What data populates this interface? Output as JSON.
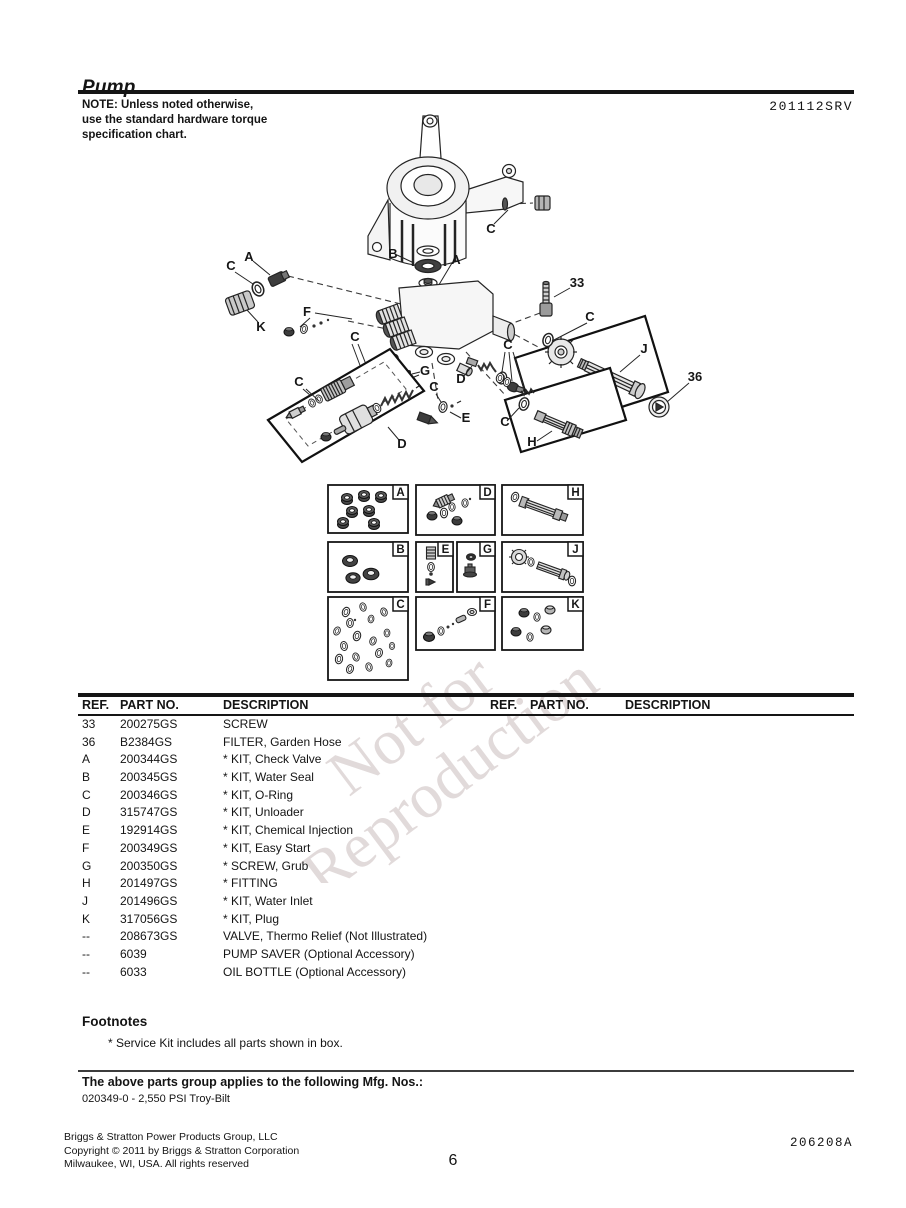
{
  "page": {
    "title": "Pump",
    "doc_number": "201112SRV",
    "note_lines": [
      "NOTE: Unless noted otherwise,",
      "use the standard hardware torque",
      "specification chart."
    ],
    "watermark": [
      "Not for",
      "Reproduction"
    ],
    "page_number": "6",
    "footer_code": "206208A",
    "footer_lines": [
      "Briggs & Stratton Power Products Group, LLC",
      "Copyright © 2011 by Briggs & Stratton Corporation",
      "Milwaukee, WI, USA. All rights reserved"
    ]
  },
  "diagram": {
    "callouts": [
      {
        "label": "C",
        "x": 491,
        "y": 233
      },
      {
        "label": "B",
        "x": 393,
        "y": 258
      },
      {
        "label": "A",
        "x": 456,
        "y": 264
      },
      {
        "label": "A",
        "x": 249,
        "y": 261
      },
      {
        "label": "C",
        "x": 231,
        "y": 270
      },
      {
        "label": "K",
        "x": 261,
        "y": 331
      },
      {
        "label": "F",
        "x": 307,
        "y": 316
      },
      {
        "label": "33",
        "x": 577,
        "y": 287
      },
      {
        "label": "C",
        "x": 590,
        "y": 321
      },
      {
        "label": "J",
        "x": 644,
        "y": 353
      },
      {
        "label": "36",
        "x": 695,
        "y": 381
      },
      {
        "label": "C",
        "x": 355,
        "y": 341
      },
      {
        "label": "C",
        "x": 299,
        "y": 386
      },
      {
        "label": "G",
        "x": 425,
        "y": 375
      },
      {
        "label": "D",
        "x": 461,
        "y": 383
      },
      {
        "label": "C",
        "x": 434,
        "y": 391
      },
      {
        "label": "C",
        "x": 508,
        "y": 349
      },
      {
        "label": "E",
        "x": 466,
        "y": 422
      },
      {
        "label": "C",
        "x": 505,
        "y": 426
      },
      {
        "label": "H",
        "x": 532,
        "y": 446
      },
      {
        "label": "D",
        "x": 402,
        "y": 448
      }
    ],
    "kit_boxes": [
      {
        "label": "A",
        "x": 328,
        "y": 485,
        "w": 80,
        "h": 48
      },
      {
        "label": "D",
        "x": 416,
        "y": 485,
        "w": 79,
        "h": 50
      },
      {
        "label": "H",
        "x": 502,
        "y": 485,
        "w": 81,
        "h": 50
      },
      {
        "label": "B",
        "x": 328,
        "y": 542,
        "w": 80,
        "h": 50
      },
      {
        "label": "E",
        "x": 416,
        "y": 542,
        "w": 37,
        "h": 50
      },
      {
        "label": "G",
        "x": 457,
        "y": 542,
        "w": 38,
        "h": 50
      },
      {
        "label": "J",
        "x": 502,
        "y": 542,
        "w": 81,
        "h": 50
      },
      {
        "label": "C",
        "x": 328,
        "y": 597,
        "w": 80,
        "h": 83
      },
      {
        "label": "F",
        "x": 416,
        "y": 597,
        "w": 79,
        "h": 53
      },
      {
        "label": "K",
        "x": 502,
        "y": 597,
        "w": 81,
        "h": 53
      }
    ]
  },
  "parts_table": {
    "headers": [
      "REF.",
      "PART NO.",
      "DESCRIPTION"
    ],
    "rows": [
      [
        "33",
        "200275GS",
        "SCREW"
      ],
      [
        "36",
        "B2384GS",
        "FILTER, Garden Hose"
      ],
      [
        "A",
        "200344GS",
        "* KIT, Check Valve"
      ],
      [
        "B",
        "200345GS",
        "* KIT, Water Seal"
      ],
      [
        "C",
        "200346GS",
        "* KIT, O-Ring"
      ],
      [
        "D",
        "315747GS",
        "* KIT, Unloader"
      ],
      [
        "E",
        "192914GS",
        "* KIT, Chemical Injection"
      ],
      [
        "F",
        "200349GS",
        "* KIT, Easy Start"
      ],
      [
        "G",
        "200350GS",
        "* SCREW, Grub"
      ],
      [
        "H",
        "201497GS",
        "* FITTING"
      ],
      [
        "J",
        "201496GS",
        "* KIT, Water Inlet"
      ],
      [
        "K",
        "317056GS",
        "* KIT, Plug"
      ],
      [
        "--",
        "208673GS",
        "VALVE, Thermo Relief (Not Illustrated)"
      ],
      [
        "--",
        "6039",
        "PUMP SAVER (Optional Accessory)"
      ],
      [
        "--",
        "6033",
        "OIL BOTTLE (Optional Accessory)"
      ]
    ]
  },
  "footnotes": {
    "heading": "Footnotes",
    "items": [
      "* Service Kit includes all parts shown in box."
    ]
  },
  "mfg": {
    "heading": "The above parts group applies to the following Mfg. Nos.:",
    "items": [
      "020349-0 - 2,550 PSI Troy-Bilt"
    ]
  }
}
